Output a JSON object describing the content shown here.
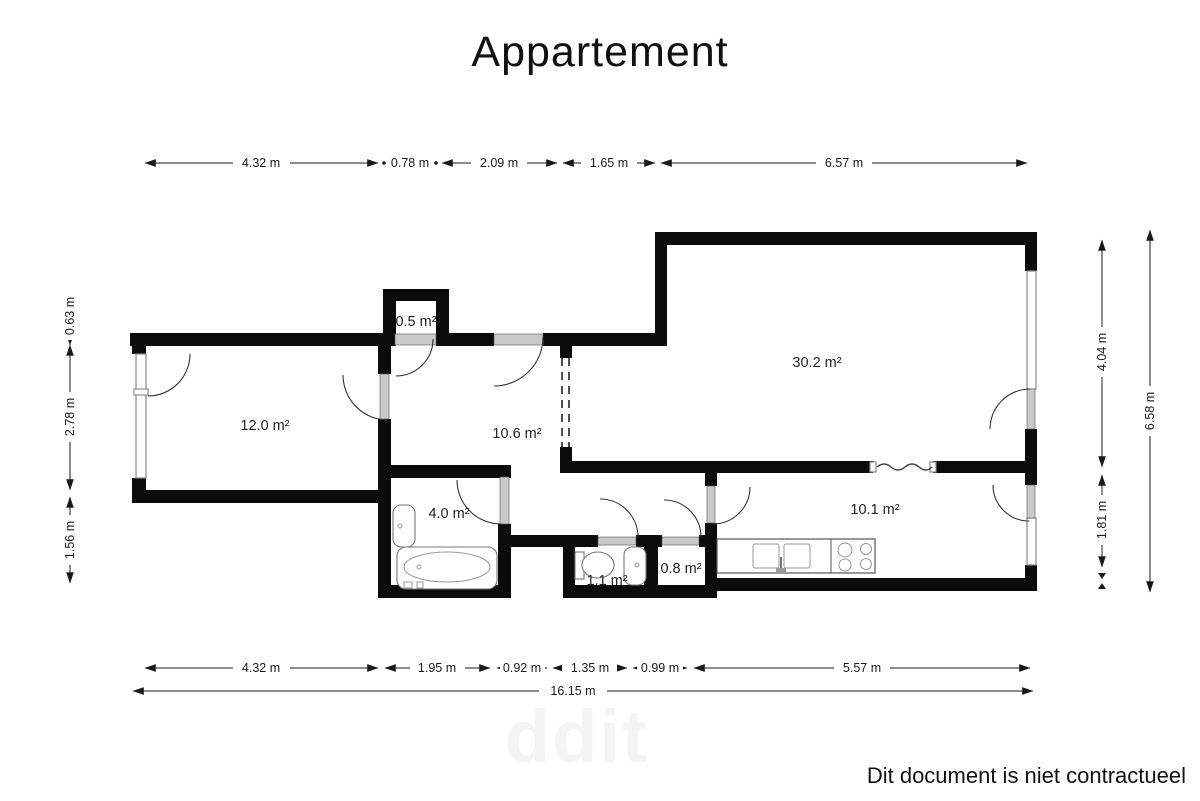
{
  "title": "Appartement",
  "footer": {
    "disclaimer": "Dit document is niet contractueel"
  },
  "watermark": "ddit",
  "rooms": {
    "bedroom": "12.0 m²",
    "closet": "0.5 m²",
    "hall": "10.6 m²",
    "living": "30.2 m²",
    "bathroom": "4.0 m²",
    "wc": "1.1 m²",
    "storage": "0.8 m²",
    "kitchen": "10.1 m²"
  },
  "dims": {
    "top": [
      "4.32 m",
      "0.78 m",
      "2.09 m",
      "1.65 m",
      "6.57 m"
    ],
    "bottom": [
      "4.32 m",
      "1.95 m",
      "0.92 m",
      "1.35 m",
      "0.99 m",
      "5.57 m"
    ],
    "total": "16.15 m",
    "left": [
      "0.63 m",
      "2.78 m",
      "1.56 m"
    ],
    "right": [
      "4.04 m",
      "1.81 m"
    ],
    "right_total": "6.58 m"
  }
}
